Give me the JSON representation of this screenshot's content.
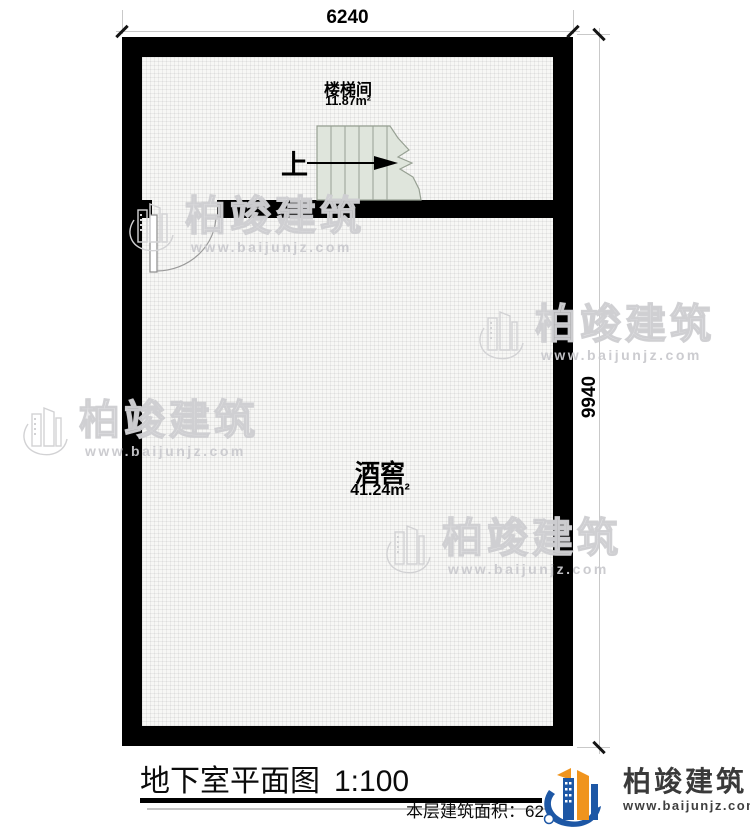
{
  "plan": {
    "dimension_top": "6240",
    "dimension_right": "9940",
    "stairwell": {
      "name": "楼梯间",
      "area": "11.87m²"
    },
    "cellar": {
      "name": "酒窖",
      "area": "41.24m²"
    },
    "stairs_up_label": "上"
  },
  "watermark": {
    "brand": "柏竣建筑",
    "url": "www.baijunjz.com"
  },
  "footer": {
    "title": "地下室平面图",
    "scale": "1:100",
    "area_text": "本层建筑面积：62.",
    "logo_brand": "柏竣建筑",
    "logo_url": "www.baijunjz.com"
  },
  "colors": {
    "wall": "#000000",
    "stair_fill": "#dfe5dc",
    "stair_stroke": "#97a093",
    "logo_blue": "#1d57a5",
    "logo_orange": "#f0941d",
    "watermark_gray": "#d0d0d2"
  }
}
